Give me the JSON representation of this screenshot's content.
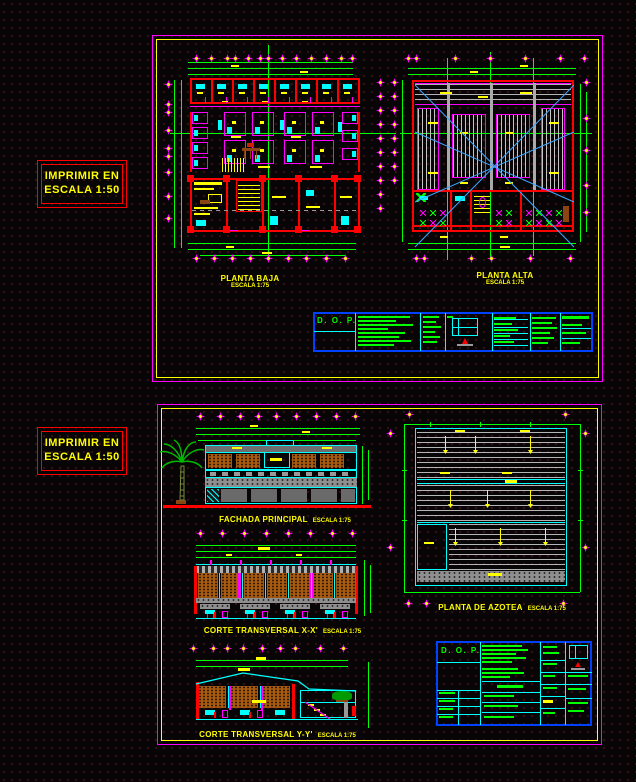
{
  "print_note": {
    "line1": "IMPRIMIR EN",
    "line2": "ESCALA 1:50"
  },
  "sheets": {
    "top": {
      "planta_baja": {
        "title": "PLANTA BAJA",
        "scale": "ESCALA 1:75"
      },
      "planta_alta": {
        "title": "PLANTA ALTA",
        "scale": "ESCALA 1:75"
      },
      "titleblock": {
        "org": "D. O. P."
      }
    },
    "bottom": {
      "fachada": {
        "title": "FACHADA PRINCIPAL",
        "scale": "ESCALA 1:75"
      },
      "corte_x": {
        "title": "CORTE TRANSVERSAL X-X'",
        "scale": "ESCALA 1:75"
      },
      "corte_y": {
        "title": "CORTE TRANSVERSAL Y-Y'",
        "scale": "ESCALA 1:75"
      },
      "azotea": {
        "title": "PLANTA DE AZOTEA",
        "scale": "ESCALA 1:75"
      },
      "titleblock": {
        "org": "D. O. P."
      }
    }
  },
  "colors": {
    "background": "#070505",
    "sheet_border": "#ff00ff",
    "sheet_inner_border": "#ffff00",
    "walls": "#ff0000",
    "dimensions": "#00ff00",
    "fixtures": "#00ffff",
    "labels": "#ffff00",
    "titleblock_border": "#0040ff",
    "titleblock_text": "#00ff00",
    "hatch_orange": "#a85a10",
    "hatch_gray": "#b4b4b4",
    "diagonal_lines": "#3da5ff",
    "note_border": "#ff0000",
    "note_text": "#ffff00"
  }
}
